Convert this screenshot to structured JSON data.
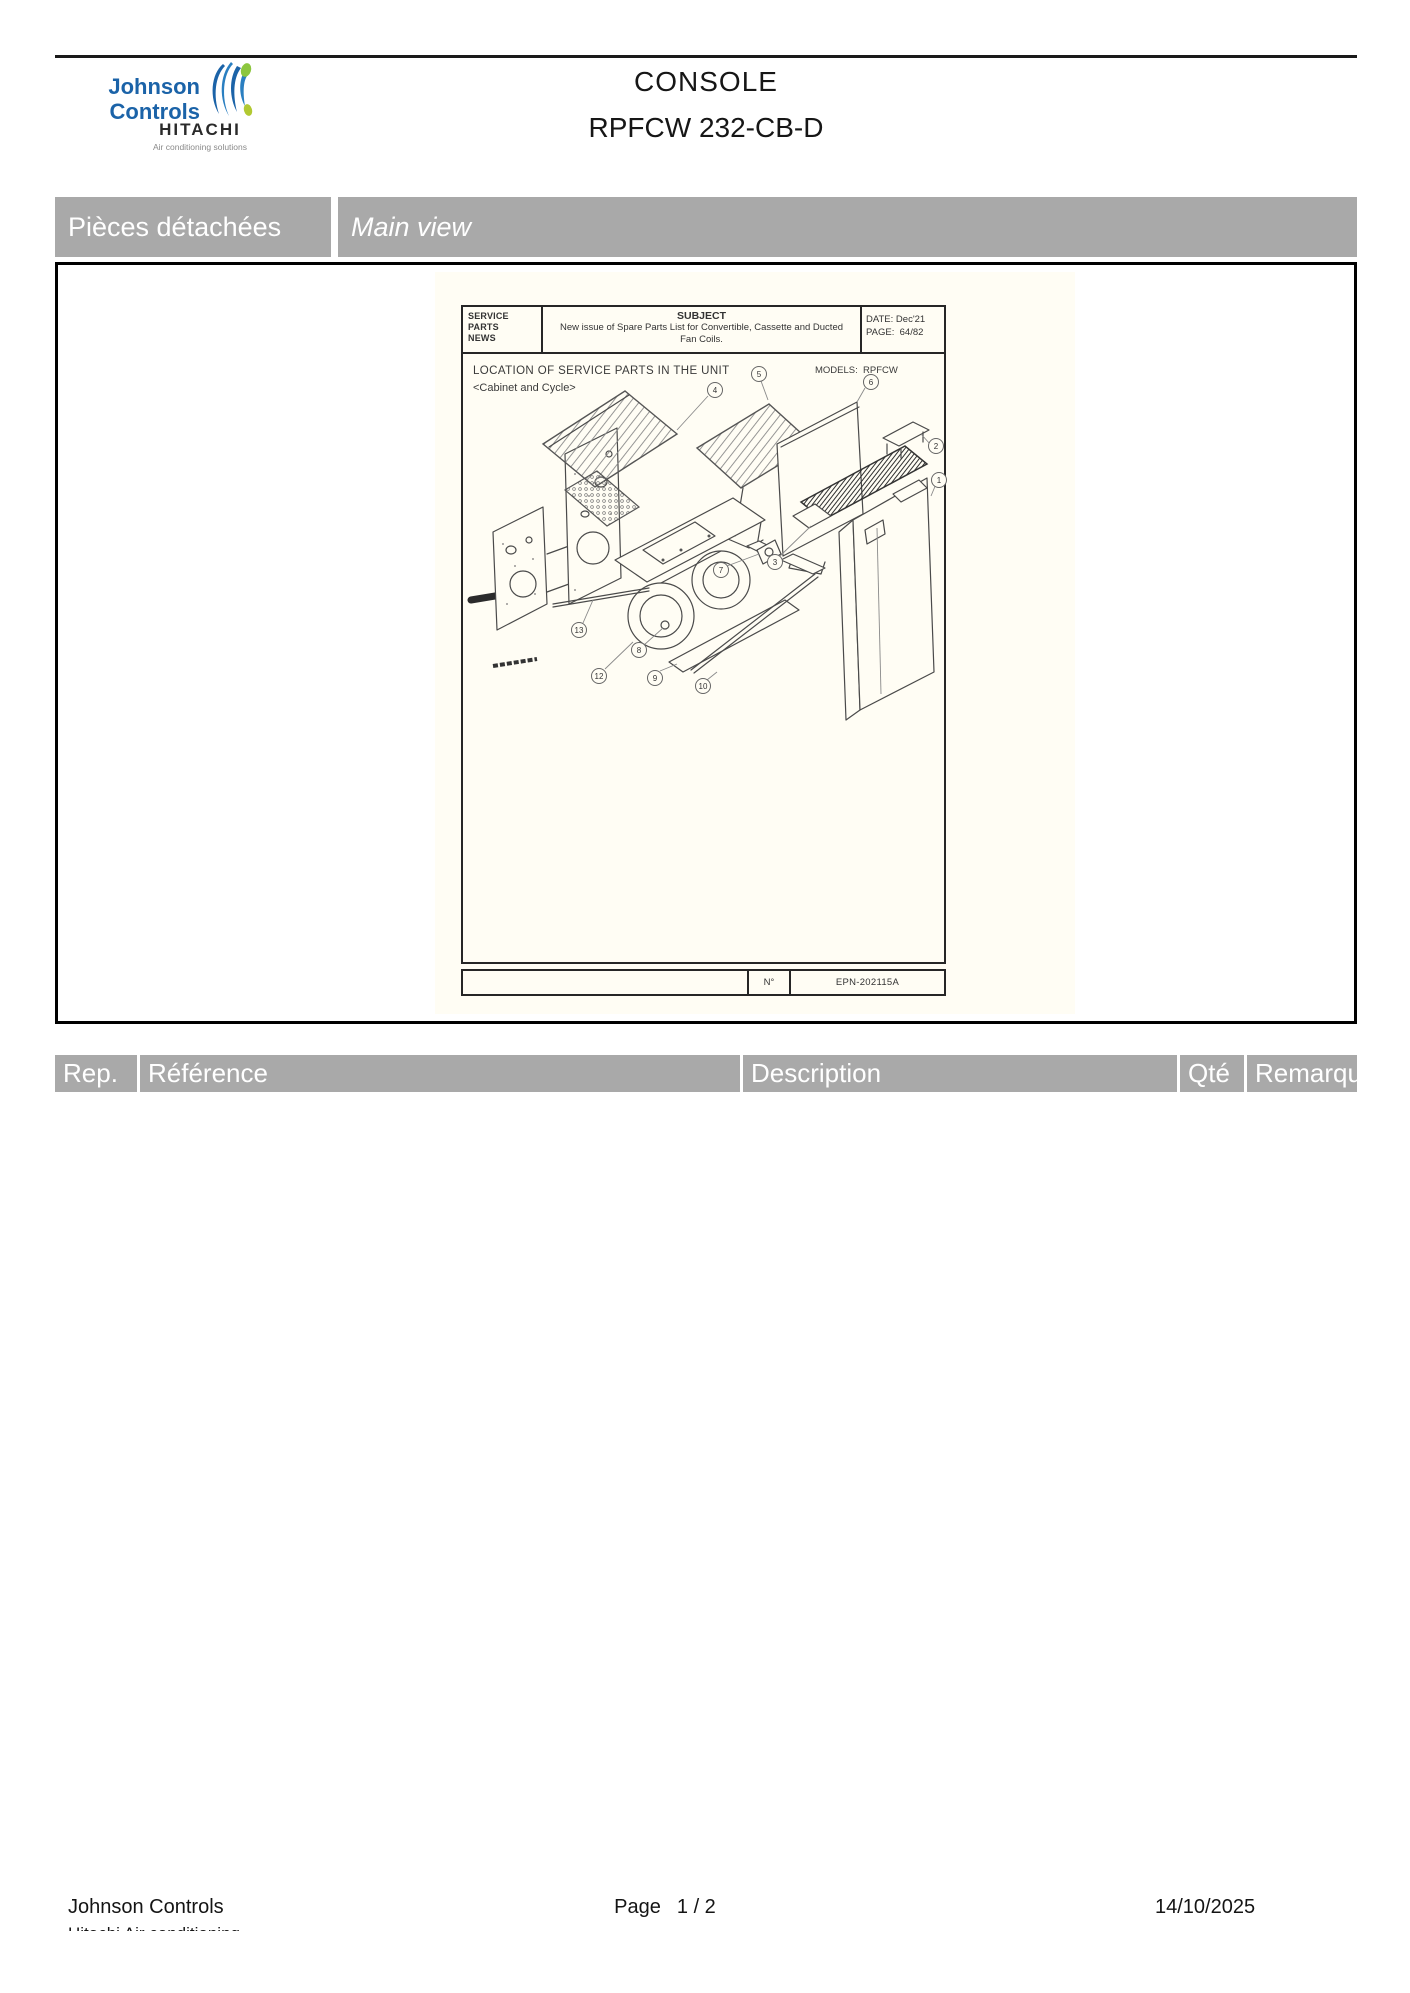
{
  "header": {
    "title": "CONSOLE",
    "model": "RPFCW 232-CB-D",
    "logo": {
      "johnson_line1": "Johnson",
      "johnson_line2": "Controls",
      "hitachi": "HITACHI",
      "tagline": "Air conditioning solutions"
    }
  },
  "section_bar": {
    "left_label": "Pièces détachées",
    "right_label": "Main view"
  },
  "spn_document": {
    "box_lines": [
      "SERVICE",
      "PARTS",
      "NEWS"
    ],
    "subject_label": "SUBJECT",
    "subject_line1": "New issue of Spare Parts List for Convertible, Cassette and Ducted",
    "subject_line2": "Fan Coils.",
    "date_label": "DATE:",
    "date_value": "Dec'21",
    "page_label": "PAGE:",
    "page_value": "64/82",
    "location_title": "LOCATION OF SERVICE PARTS IN THE UNIT",
    "location_subtitle": "<Cabinet and Cycle>",
    "models_label": "MODELS:",
    "models_value": "RPFCW",
    "number_label": "N°",
    "drawing_number": "EPN-202115A",
    "callouts": [
      "4",
      "5",
      "6",
      "2",
      "1",
      "3",
      "7",
      "13",
      "8",
      "12",
      "9",
      "10"
    ]
  },
  "parts_table": {
    "columns": [
      "Rep.",
      "Référence",
      "Description",
      "Qté",
      "Remarques"
    ]
  },
  "page_footer": {
    "company": "Johnson Controls",
    "clipped_text": "Hitachi Air conditioning",
    "page_label": "Page",
    "page_value": "1 / 2",
    "date": "14/10/2025"
  },
  "colors": {
    "bar_gray": "#a9a9a9",
    "paper": "#fffdf4",
    "logo_blue": "#1b63a8",
    "logo_green": "#8cc63e",
    "line_black": "#1a1a1a"
  }
}
